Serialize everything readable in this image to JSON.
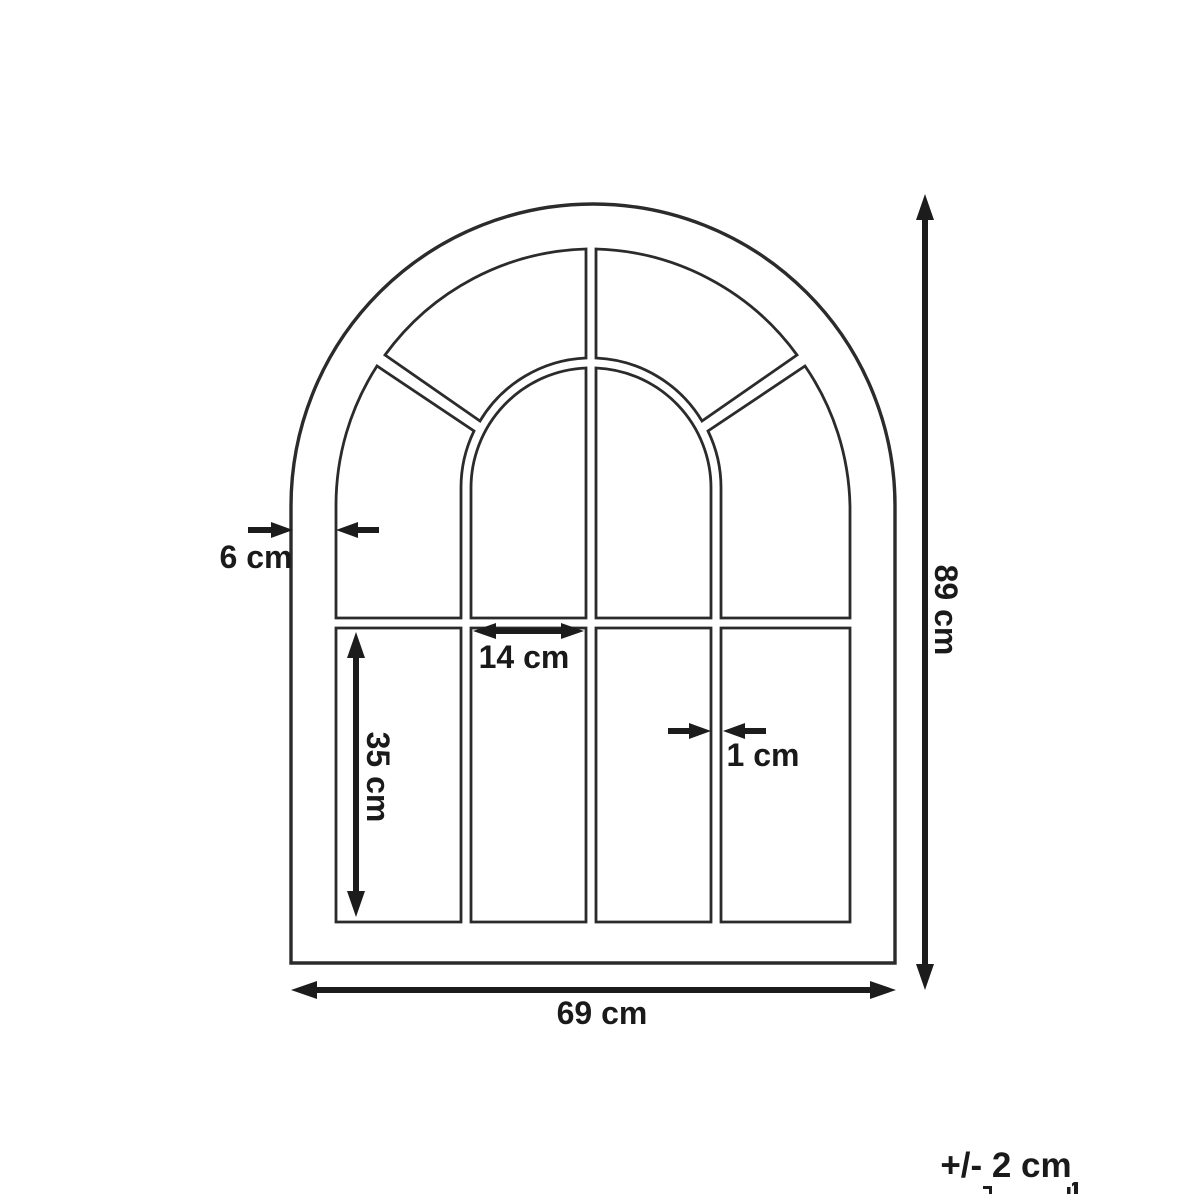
{
  "page": {
    "background": "#ffffff"
  },
  "diagram": {
    "title": "arched-window-mirror-dimension-diagram",
    "colors": {
      "line": "#2b2b2b",
      "text": "#1a1a1a"
    },
    "labels": {
      "frame_thickness": "6 cm",
      "pane_width": "14 cm",
      "pane_height": "35 cm",
      "bar_thickness": "1 cm",
      "overall_height": "89 cm",
      "overall_width": "69 cm",
      "tolerance": "+/- 2 cm"
    }
  }
}
